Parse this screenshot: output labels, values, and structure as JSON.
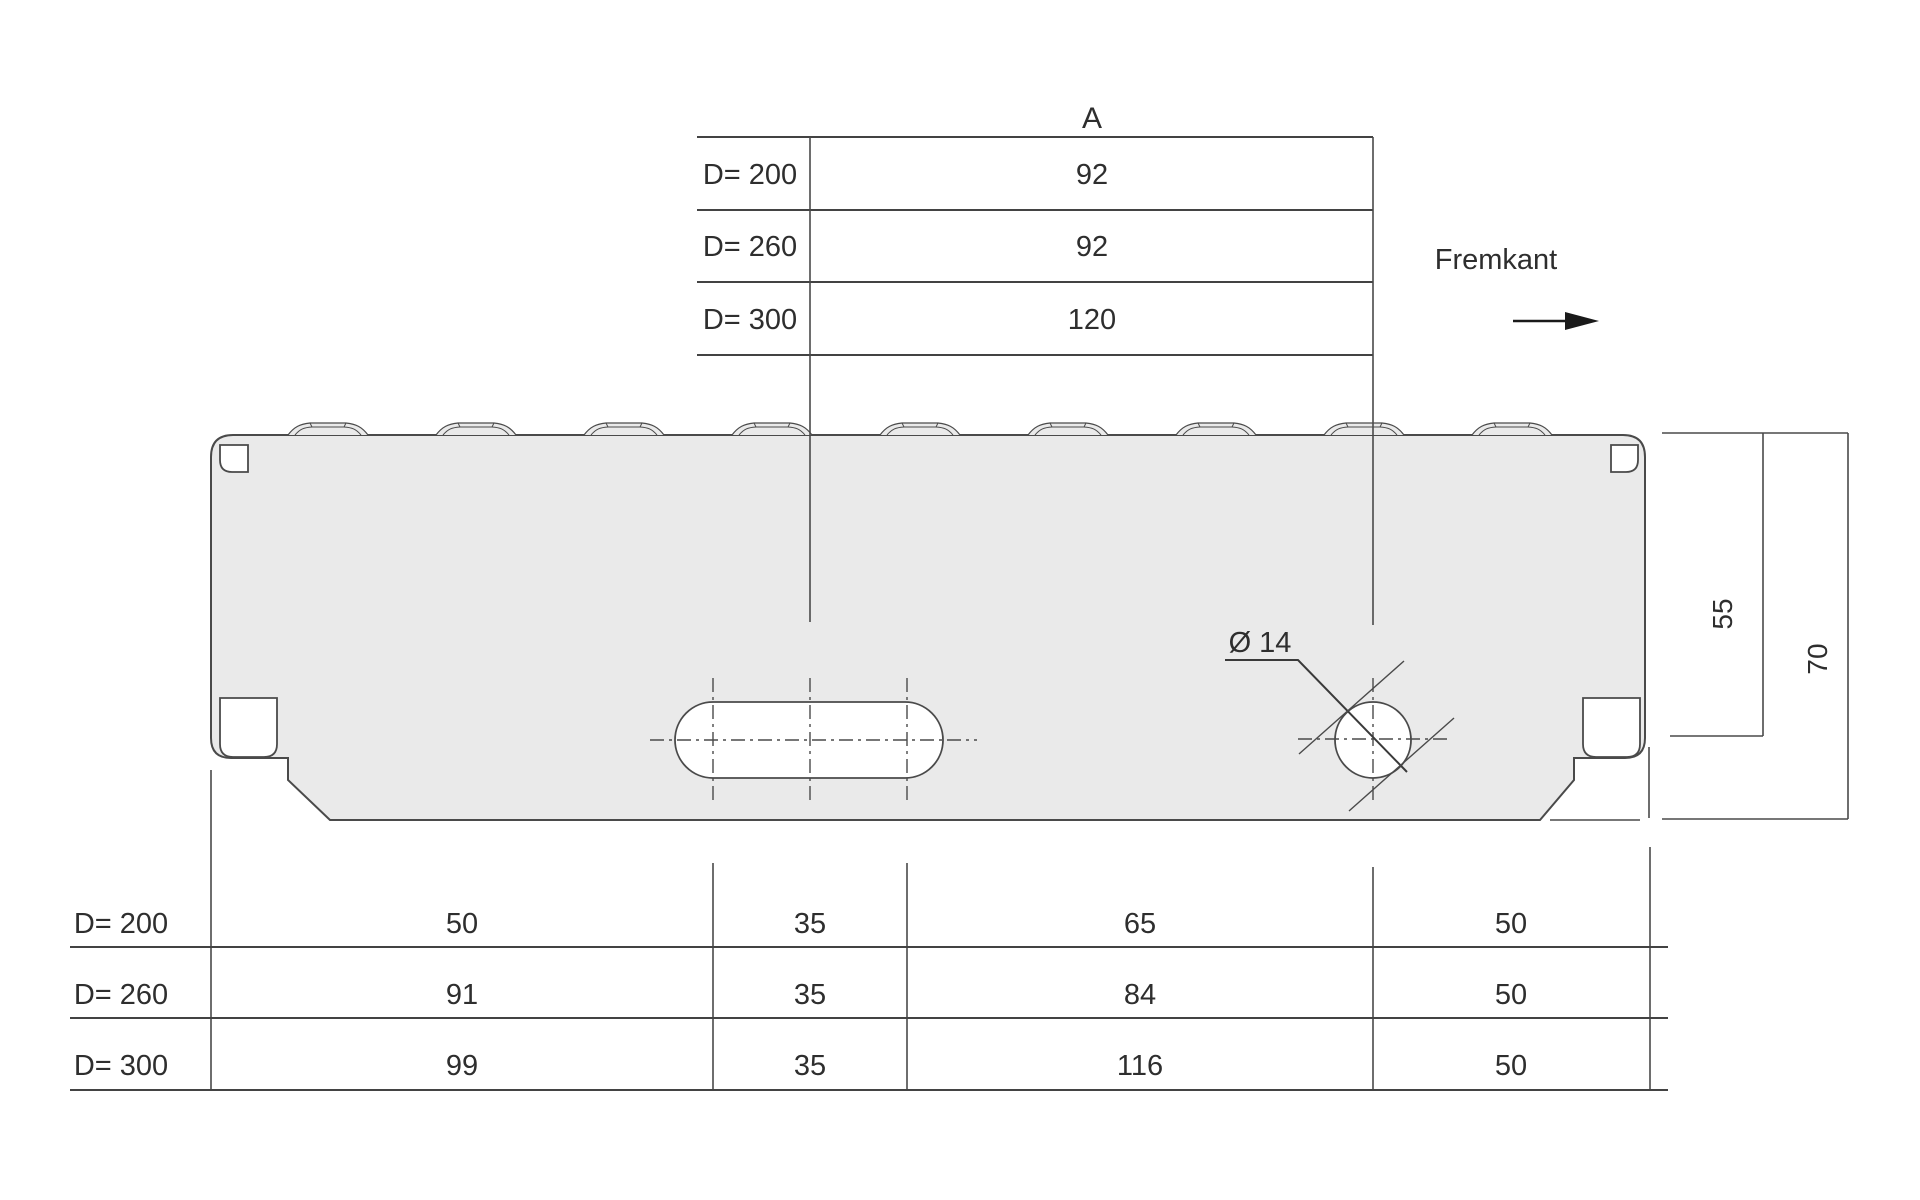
{
  "top_table": {
    "header": "A",
    "rows": [
      {
        "label": "D= 200",
        "value": "92"
      },
      {
        "label": "D= 260",
        "value": "92"
      },
      {
        "label": "D= 300",
        "value": "120"
      }
    ]
  },
  "bottom_table": {
    "rows": [
      {
        "label": "D= 200",
        "values": [
          "50",
          "35",
          "65",
          "50"
        ]
      },
      {
        "label": "D= 260",
        "values": [
          "91",
          "35",
          "84",
          "50"
        ]
      },
      {
        "label": "D= 300",
        "values": [
          "99",
          "35",
          "116",
          "50"
        ]
      }
    ]
  },
  "annotations": {
    "front_edge_label": "Fremkant",
    "hole_diameter_label": "Ø 14"
  },
  "dimensions": {
    "top_to_hole_center": "55",
    "total_height": "70"
  },
  "colors": {
    "panel_fill": "#eaeaea",
    "line_color": "#4a4a4a",
    "text_color": "#2e2e2e",
    "background": "#ffffff"
  }
}
